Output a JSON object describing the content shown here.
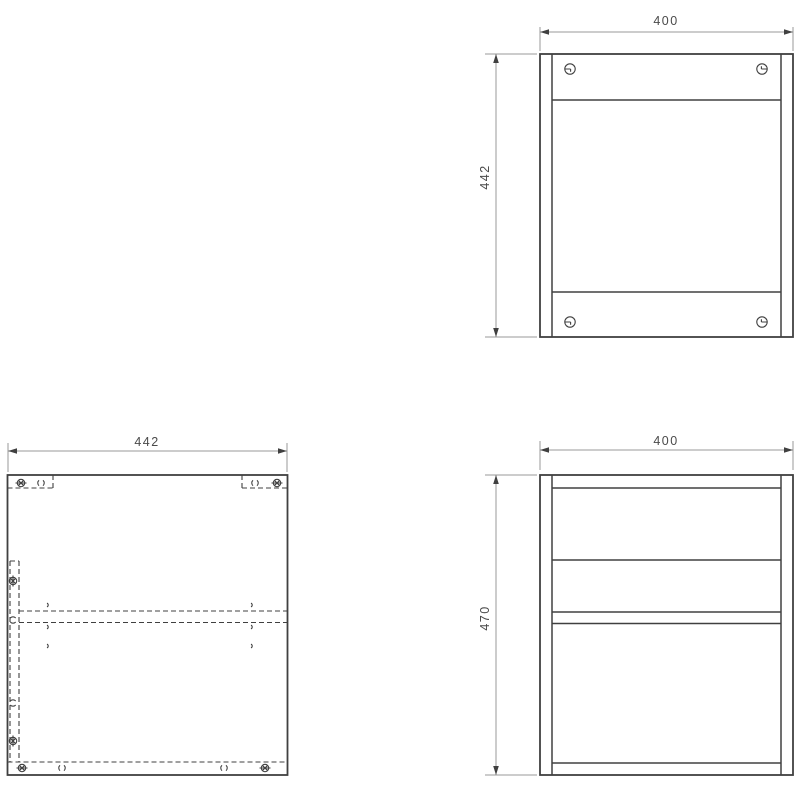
{
  "drawing": {
    "background_color": "#ffffff",
    "object_line_color": "#404040",
    "dimension_line_color": "#9a9a9a",
    "dimension_text_color": "#4a4a4a",
    "views": {
      "front": {
        "width_label": "400",
        "height_label": "442"
      },
      "top": {
        "width_label": "442"
      },
      "side": {
        "width_label": "400",
        "height_label": "470"
      }
    },
    "symbols": {
      "cam_lock": "cam-lock-icon",
      "dowel_hole": "dowel-hole-icon",
      "pilot_hole": "pilot-hole-icon"
    }
  }
}
